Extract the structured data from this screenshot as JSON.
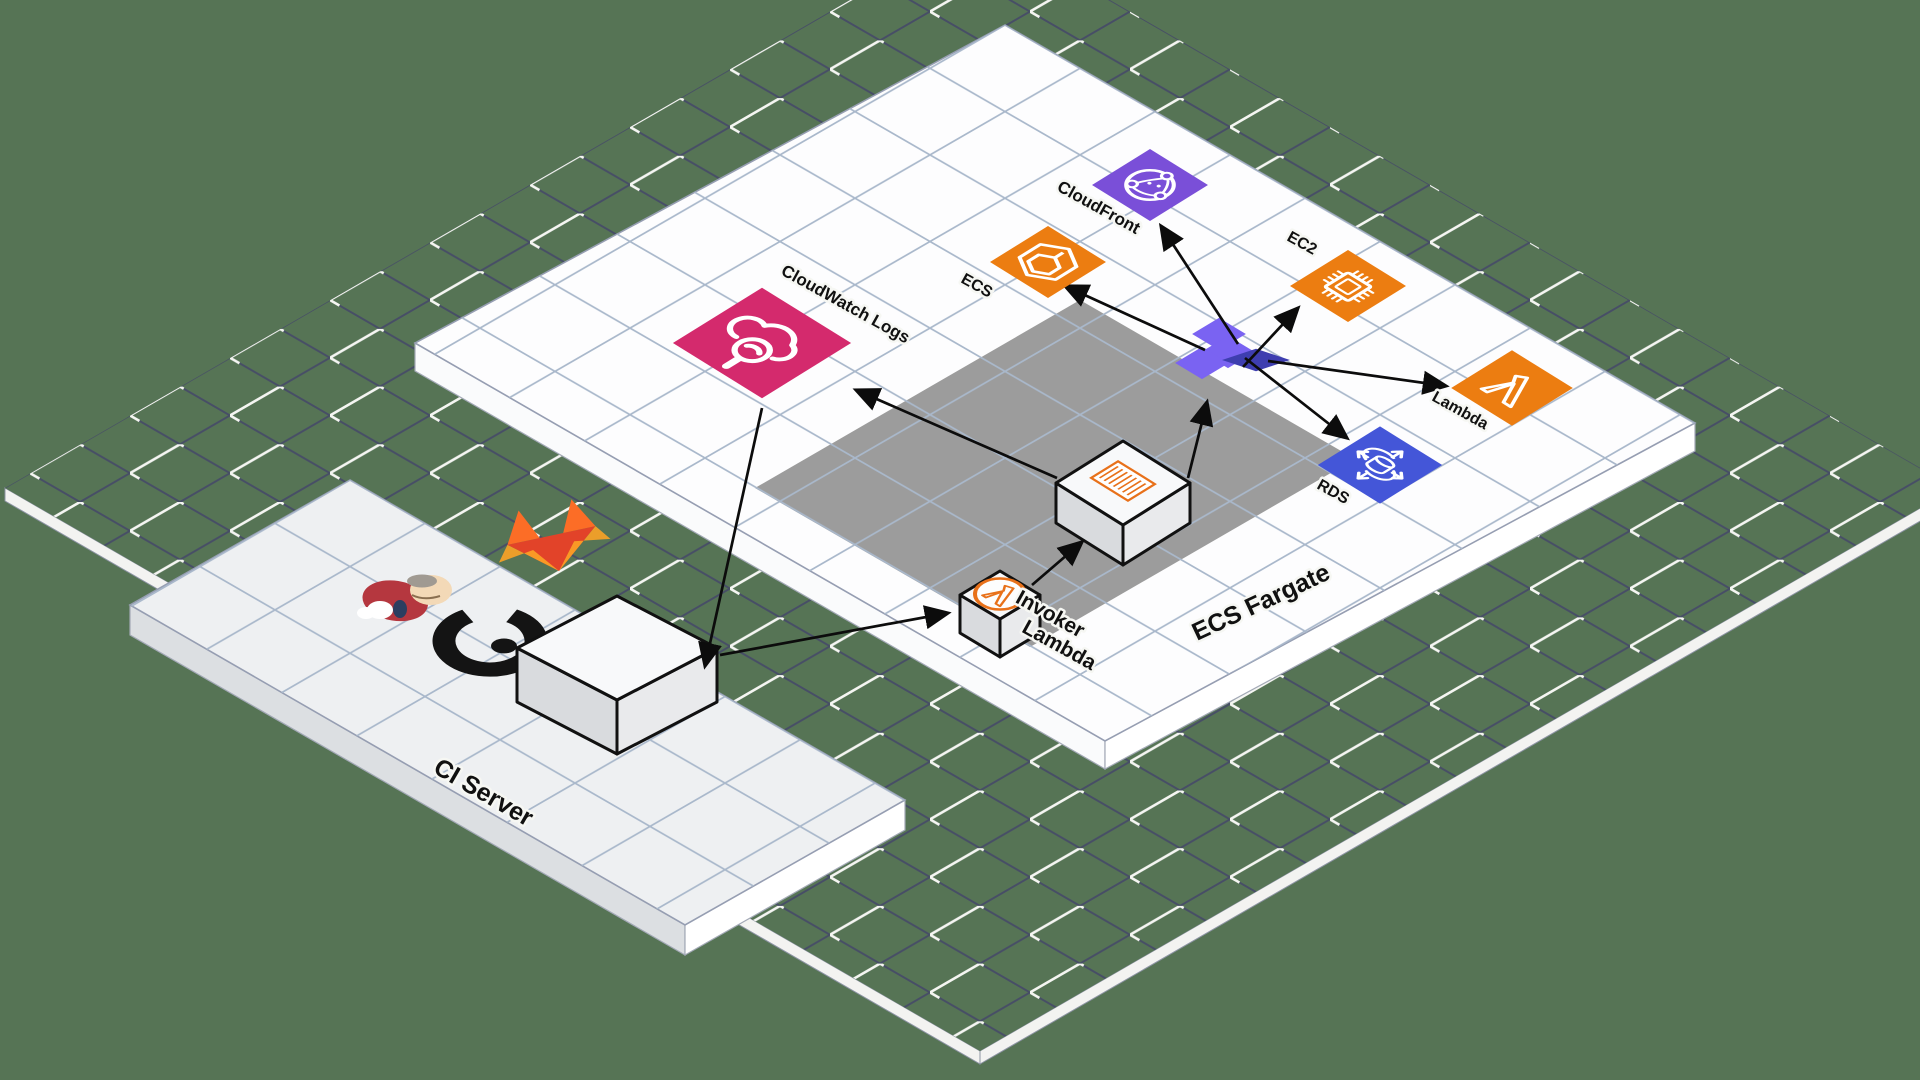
{
  "diagram_title": "Isometric AWS CI/CD architecture diagram",
  "nodes": {
    "cloudwatch": {
      "label": "CloudWatch Logs",
      "color": "#d42a6d"
    },
    "ecs": {
      "label": "ECS",
      "color": "#ec7d11"
    },
    "cloudfront": {
      "label": "CloudFront",
      "color": "#7a4fd8"
    },
    "ec2": {
      "label": "EC2",
      "color": "#ec7d11"
    },
    "lambda": {
      "label": "Lambda",
      "color": "#ec7d11"
    },
    "rds": {
      "label": "RDS",
      "color": "#4456d8"
    },
    "invoker_lambda": {
      "line1": "Invoker",
      "line2": "Lambda"
    },
    "ecs_fargate": {
      "label": "ECS Fargate"
    },
    "ci_server": {
      "label": "CI Server"
    }
  },
  "logos": {
    "jenkins": "jenkins-mascot",
    "gitlab": "gitlab-tanuki-logo",
    "ring": "black-ring-logo",
    "terraform_hub": "terraform-hub-icon"
  },
  "colors": {
    "background": "#567455",
    "base_grid": "#474e66",
    "base_grid_highlight": "#f5f6f2",
    "platform": "#fdfdfe",
    "platform_grid": "#a9b8cb",
    "ci_platform": "#eef0f2",
    "fargate_zone": "#9c9c9c",
    "arrow": "#0c0c0c",
    "aws_pink": "#d42a6d",
    "aws_orange": "#ec7d11",
    "aws_purple": "#7a4fd8",
    "aws_blue": "#4456d8",
    "terraform_light": "#7a63f2",
    "terraform_dark": "#3e3eb0",
    "lambda_badge_orange": "#e8711a",
    "box_side": "#d9dbde",
    "box_top": "#f8f9fa"
  }
}
